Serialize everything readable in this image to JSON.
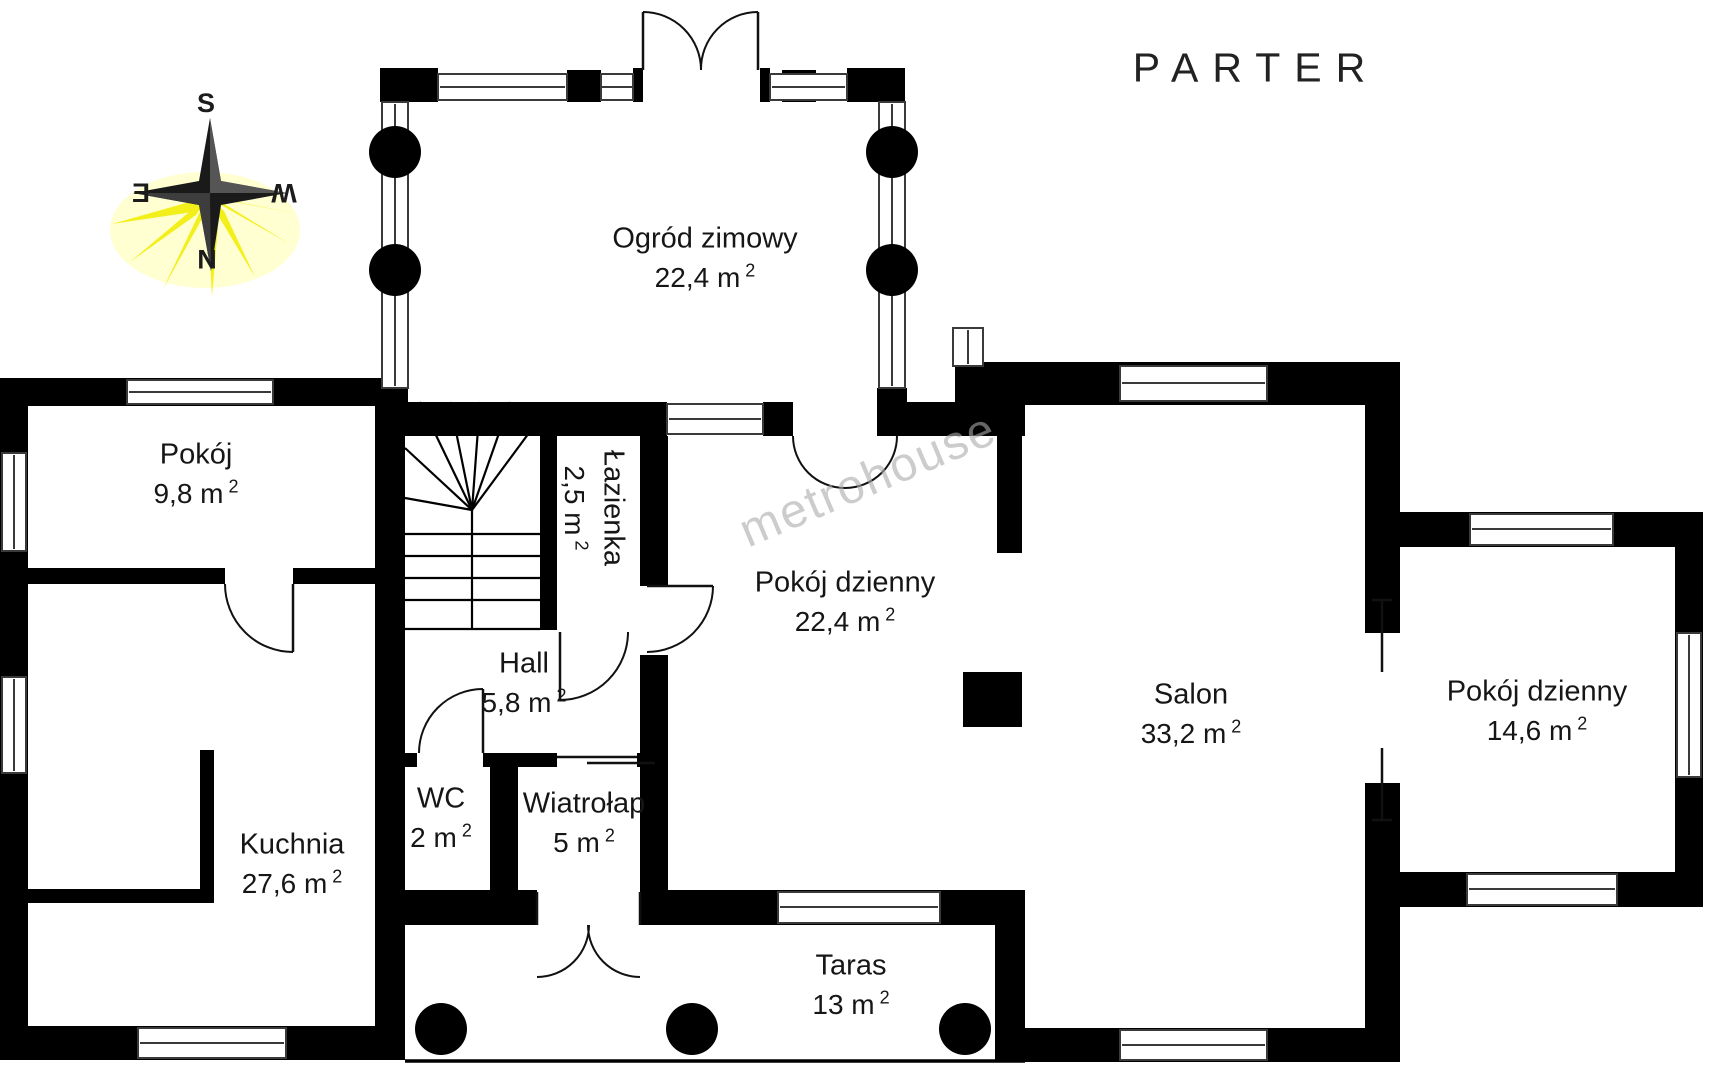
{
  "title": "PARTER",
  "watermark": "metrohouse",
  "area_superscript": "2",
  "compass": {
    "top": "S",
    "bottom": "N",
    "left": "E",
    "right": "W"
  },
  "colors": {
    "walls": "#000000",
    "background": "#ffffff",
    "compass_rays": "#f3ef1b",
    "compass_star": "#1a1a1a",
    "label_text": "#161616",
    "watermark": "#ababab"
  },
  "rooms": [
    {
      "name": "Ogród zimowy",
      "area": "22,4 m"
    },
    {
      "name": "Pokój",
      "area": "9,8 m"
    },
    {
      "name": "Łazienka",
      "area": "2,5 m"
    },
    {
      "name": "Pokój dzienny",
      "area": "22,4 m"
    },
    {
      "name": "Salon",
      "area": "33,2 m"
    },
    {
      "name": "Pokój dzienny",
      "area": "14,6 m"
    },
    {
      "name": "Hall",
      "area": "5,8 m"
    },
    {
      "name": "WC",
      "area": "2 m"
    },
    {
      "name": "Wiatrołap",
      "area": "5 m"
    },
    {
      "name": "Kuchnia",
      "area": "27,6 m"
    },
    {
      "name": "Taras",
      "area": "13 m"
    }
  ]
}
